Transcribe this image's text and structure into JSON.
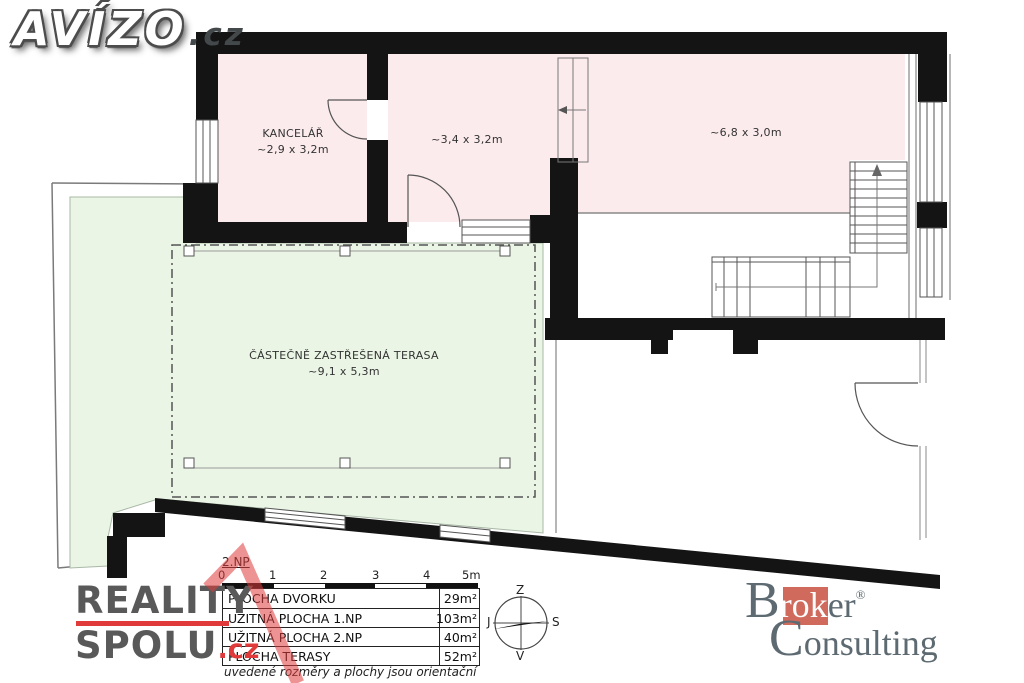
{
  "logos": {
    "avizo": {
      "name": "AVÍZO",
      "tld": ".cz"
    },
    "reality_spolu": {
      "line1": "REALITY",
      "line2": "SPOLU",
      "tld": ".cz"
    },
    "broker_consulting": {
      "b": "B",
      "rok": "rok",
      "er": "er",
      "reg": "®",
      "c": "C",
      "onsulting": "onsulting"
    }
  },
  "plan": {
    "floor_label": "2.NP",
    "rooms": {
      "office": {
        "name": "KANCELÁŘ",
        "dims": "~2,9 x 3,2m"
      },
      "room_middle": {
        "dims": "~3,4 x 3,2m"
      },
      "room_large": {
        "dims": "~6,8 x 3,0m"
      },
      "terrace": {
        "name": "ČÁSTEČNĚ ZASTŘEŠENÁ TERASA",
        "dims": "~9,1 x 5,3m"
      }
    },
    "compass": {
      "top": "Z",
      "left": "J",
      "right": "S",
      "bottom": "V"
    }
  },
  "scalebar": {
    "ticks": [
      "0",
      "1",
      "2",
      "3",
      "4",
      "5m"
    ]
  },
  "areas_table": {
    "rows": [
      {
        "label": "PLOCHA DVORKU",
        "value": "29m²"
      },
      {
        "label": "UŽITNÁ PLOCHA 1.NP",
        "value": "103m²"
      },
      {
        "label": "UŽITNÁ PLOCHA 2.NP",
        "value": "40m²"
      },
      {
        "label": "PLOCHA TERASY",
        "value": "52m²"
      }
    ],
    "note": "uvedené rozměry a plochy jsou orientační"
  },
  "colors": {
    "room_fill": "#fcebed",
    "terrace_fill": "#eaf5e6",
    "wall": "#141414",
    "accent_red": "#e23c3c",
    "broker_red": "#cf6a5c",
    "logo_gray": "#5d6a71"
  }
}
